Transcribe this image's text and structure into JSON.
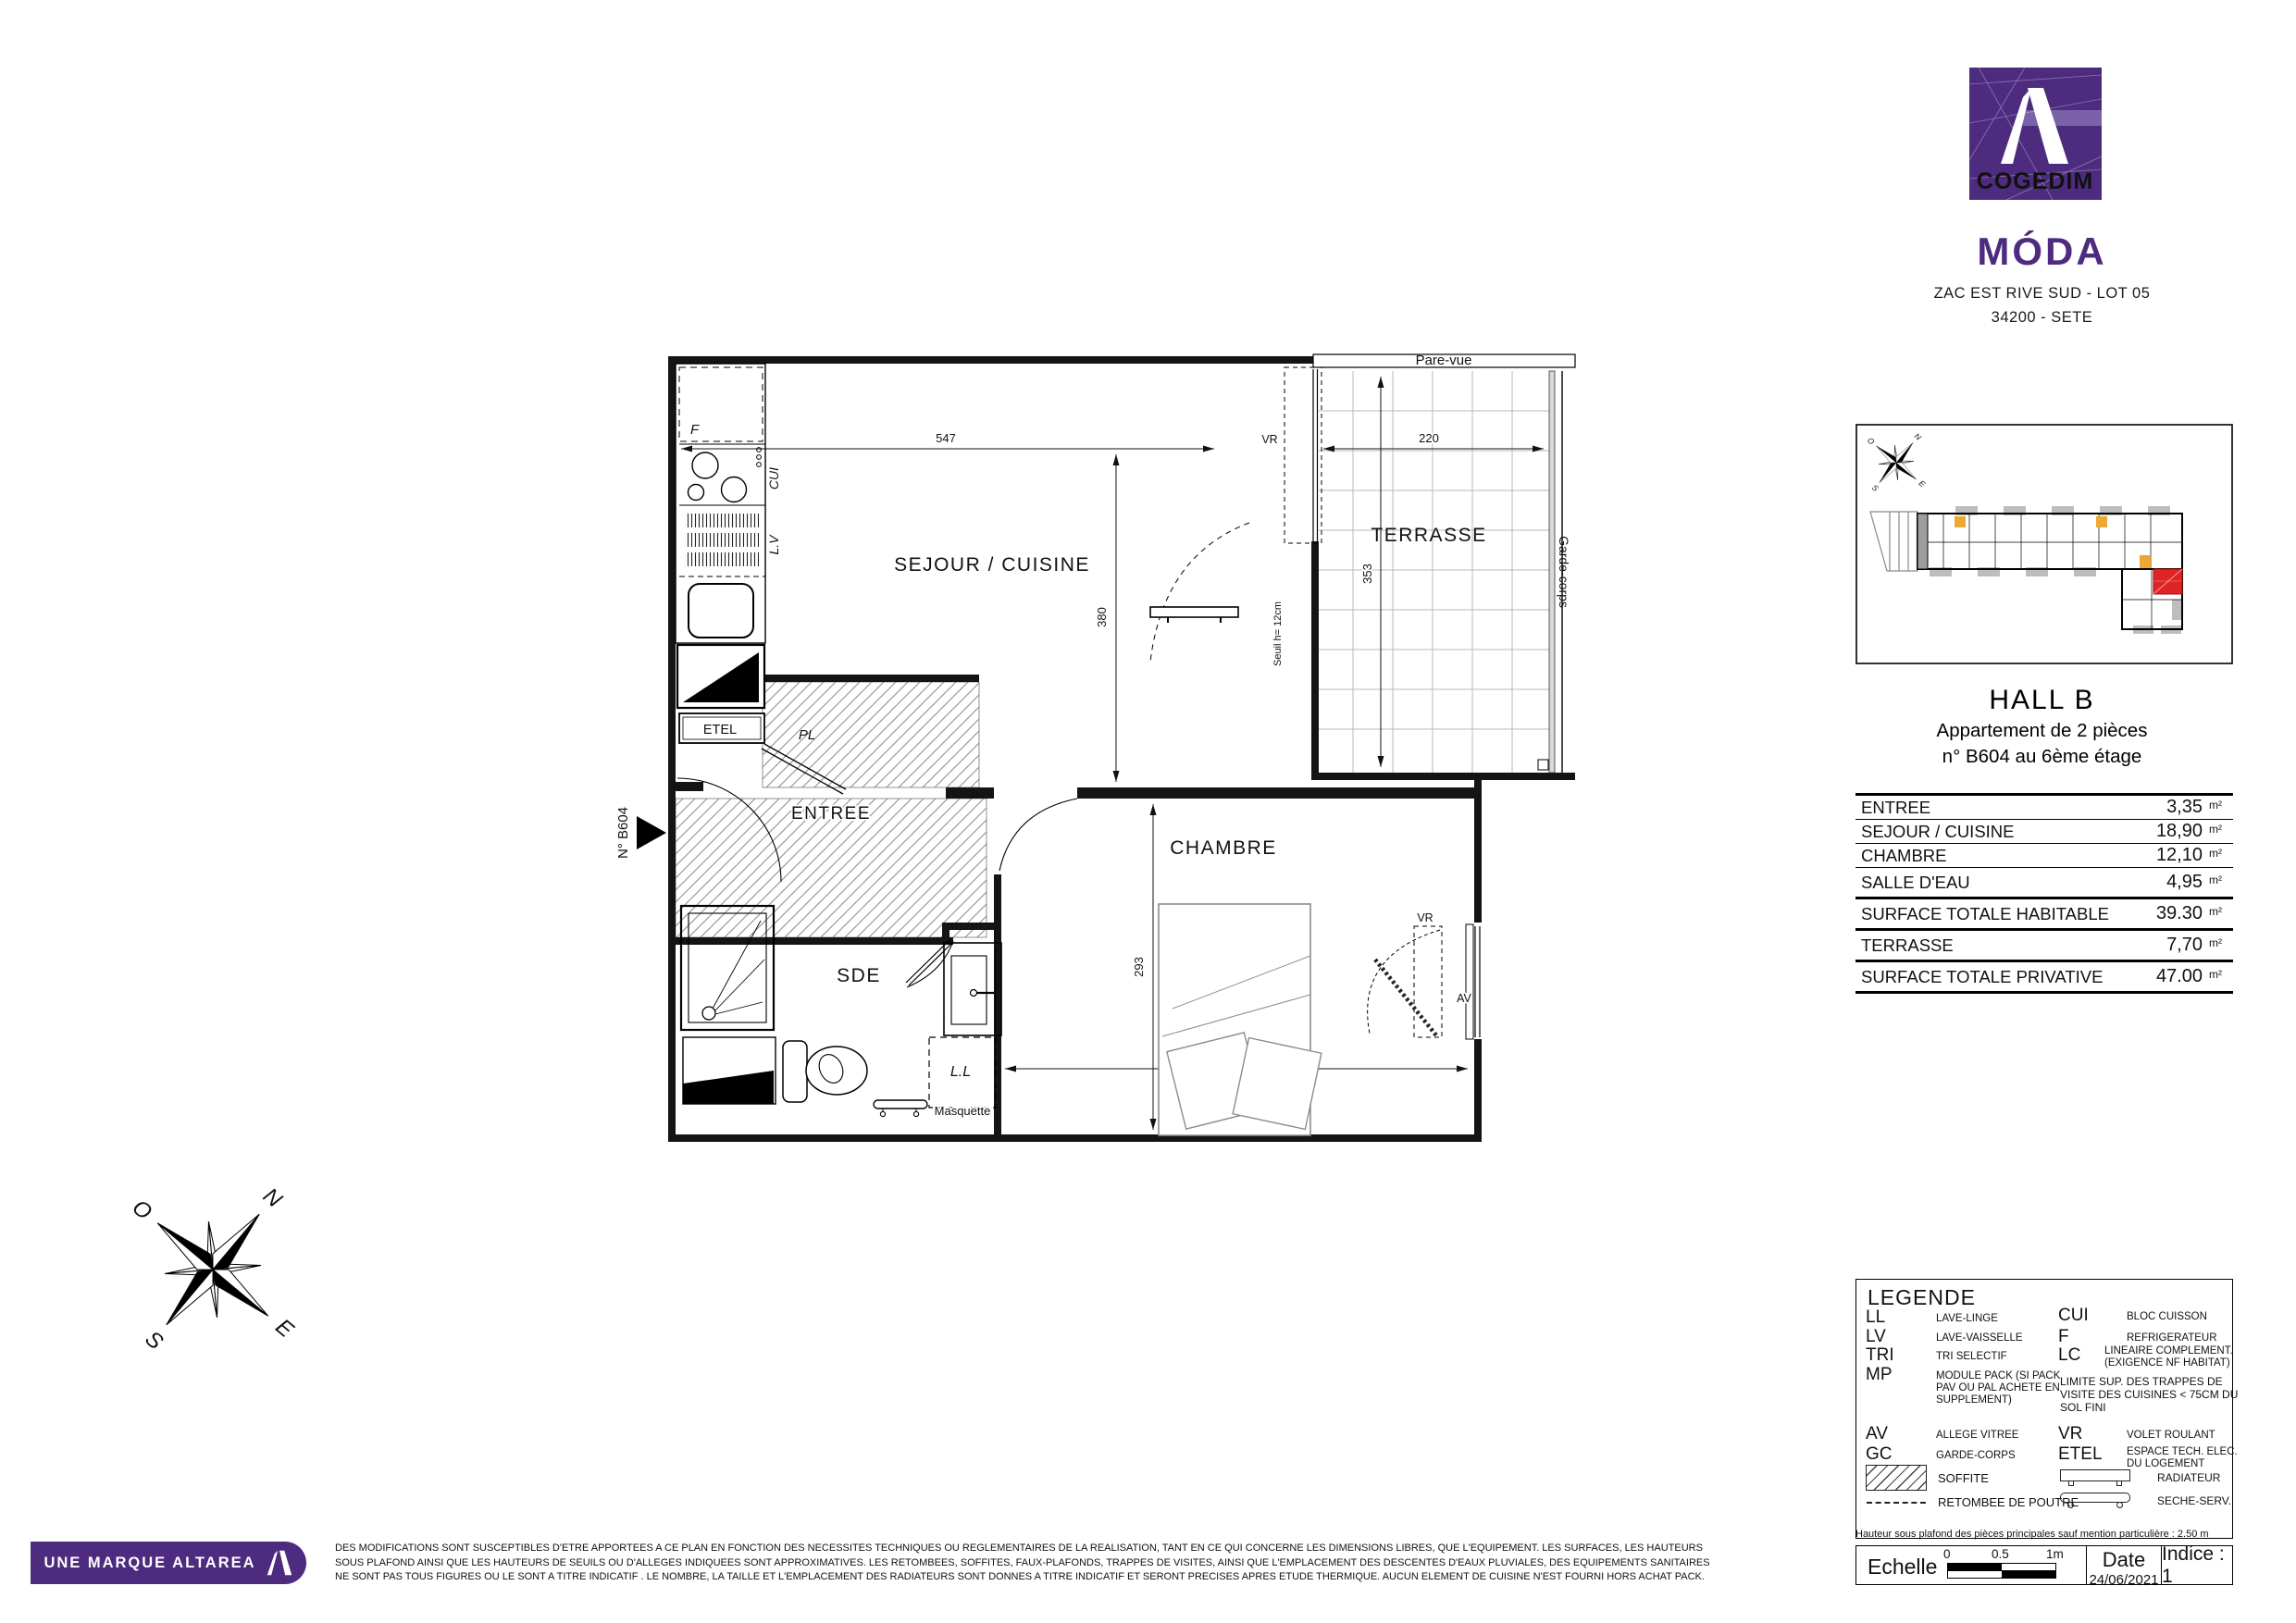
{
  "branding": {
    "logo_text": "COGEDIM",
    "project": "MÓDA",
    "address_line1": "ZAC EST RIVE SUD - LOT 05",
    "address_line2": "34200 - SETE",
    "footer_brand": "UNE MARQUE ALTAREA",
    "purple": "#4d2b7f"
  },
  "unit": {
    "hall": "HALL B",
    "type_line": "Appartement de 2 pièces",
    "number_line": "n° B604 au 6ème étage",
    "door_marker": "N° B604"
  },
  "areas": {
    "rows": [
      {
        "label": "ENTREE",
        "value": "3,35",
        "unit": "m²"
      },
      {
        "label": "SEJOUR / CUISINE",
        "value": "18,90",
        "unit": "m²"
      },
      {
        "label": "CHAMBRE",
        "value": "12,10",
        "unit": "m²"
      },
      {
        "label": "SALLE D'EAU",
        "value": "4,95",
        "unit": "m²"
      },
      {
        "label": "SURFACE TOTALE HABITABLE",
        "value": "39.30",
        "unit": "m²"
      },
      {
        "label": "TERRASSE",
        "value": "7,70",
        "unit": "m²"
      },
      {
        "label": "SURFACE TOTALE PRIVATIVE",
        "value": "47.00",
        "unit": "m²"
      }
    ]
  },
  "plan": {
    "rooms": {
      "sejour": "SEJOUR / CUISINE",
      "terrasse": "TERRASSE",
      "chambre": "CHAMBRE",
      "entree": "ENTREE",
      "sde": "SDE"
    },
    "annotations": {
      "pare_vue": "Pare-vue",
      "garde_corps": "Garde-corps",
      "seuil": "Seuil h= 12cm",
      "masquette": "Masquette",
      "vr_sejour": "VR",
      "vr_chambre": "VR",
      "av": "AV",
      "f": "F",
      "cui": "CUI",
      "lv": "L.V",
      "ll": "L.L",
      "etel": "ETEL",
      "pl": "PL"
    },
    "dims": {
      "sejour_w": "547",
      "sejour_h": "380",
      "terrasse_w": "220",
      "terrasse_h": "353",
      "chambre_h": "293",
      "chambre_w": "394"
    }
  },
  "compass": {
    "n": "N",
    "e": "E",
    "s": "S",
    "o": "O"
  },
  "legend": {
    "title": "LEGENDE",
    "left": [
      {
        "abbr": "LL",
        "lines": [
          "LAVE-LINGE"
        ]
      },
      {
        "abbr": "LV",
        "lines": [
          "LAVE-VAISSELLE"
        ]
      },
      {
        "abbr": "TRI",
        "lines": [
          "TRI SELECTIF"
        ]
      },
      {
        "abbr": "MP",
        "lines": [
          "MODULE PACK (SI PACK",
          " PAV OU PAL ACHETE EN",
          "SUPPLEMENT)"
        ]
      },
      {
        "abbr": "AV",
        "lines": [
          "ALLEGE VITREE"
        ]
      },
      {
        "abbr": "GC",
        "lines": [
          "GARDE-CORPS"
        ]
      }
    ],
    "right": [
      {
        "abbr": "CUI",
        "lines": [
          "BLOC CUISSON"
        ]
      },
      {
        "abbr": "F",
        "lines": [
          "REFRIGERATEUR"
        ]
      },
      {
        "abbr": "LC",
        "lines": [
          "LINEAIRE COMPLEMENT.",
          "(EXIGENCE NF HABITAT)"
        ]
      },
      {
        "abbr": "",
        "lines": [
          "LIMITE SUP. DES TRAPPES DE",
          "VISITE DES CUISINES < 75CM DU",
          " SOL FINI"
        ]
      },
      {
        "abbr": "VR",
        "lines": [
          "VOLET ROULANT"
        ]
      },
      {
        "abbr": "ETEL",
        "lines": [
          "ESPACE TECH. ELEC.",
          "DU LOGEMENT"
        ]
      }
    ],
    "soffite": "SOFFITE",
    "retombee": "RETOMBEE DE POUTRE",
    "radiateur": "RADIATEUR",
    "seche": "SECHE-SERV."
  },
  "notes": {
    "hauteur": "Hauteur sous plafond des pièces principales sauf mention particulière : 2.50 m",
    "disclaimer_lines": [
      "DES MODIFICATIONS SONT SUSCEPTIBLES D'ETRE APPORTEES A CE PLAN EN FONCTION DES NECESSITES TECHNIQUES OU REGLEMENTAIRES DE LA REALISATION, TANT EN CE QUI CONCERNE LES DIMENSIONS LIBRES, QUE L'EQUIPEMENT. LES SURFACES, LES HAUTEURS",
      "SOUS PLAFOND AINSI QUE LES HAUTEURS DE SEUILS OU D'ALLEGES INDIQUEES SONT APPROXIMATIVES. LES RETOMBEES, SOFFITES, FAUX-PLAFONDS, TRAPPES DE VISITES, AINSI QUE L'EMPLACEMENT DES DESCENTES D'EAUX PLUVIALES, DES EQUIPEMENTS SANITAIRES",
      "NE SONT PAS TOUS FIGURES OU LE SONT A TITRE INDICATIF . LE NOMBRE, LA TAILLE ET L'EMPLACEMENT DES RADIATEURS SONT DONNES A TITRE INDICATIF ET SERONT PRECISES APRES ETUDE THERMIQUE. AUCUN ELEMENT DE CUISINE N'EST FOURNI HORS ACHAT PACK."
    ]
  },
  "titleblock": {
    "echelle": "Echelle",
    "scale_ticks": [
      "0",
      "0.5",
      "1m"
    ],
    "date_label": "Date",
    "date_value": "24/06/2021",
    "indice": "Indice : 1"
  }
}
